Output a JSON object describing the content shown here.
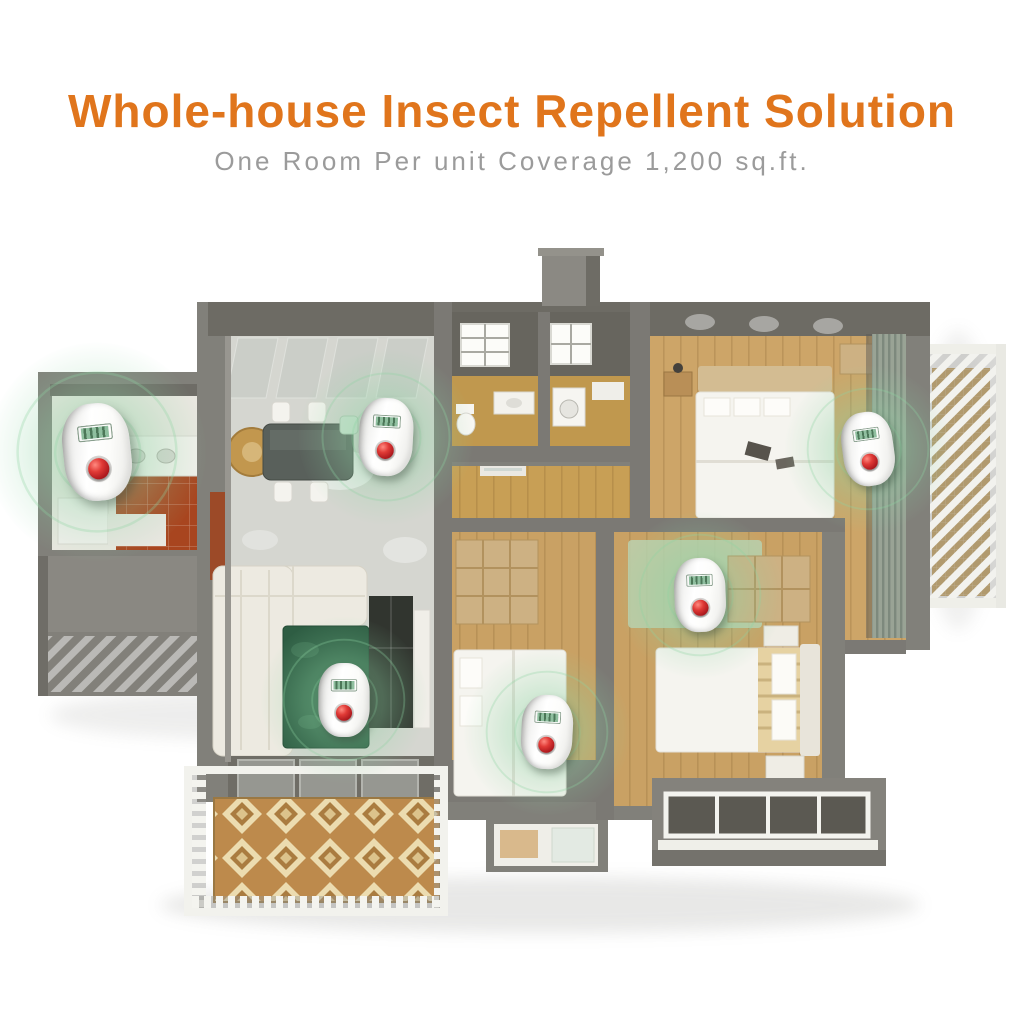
{
  "header": {
    "title": "Whole-house Insect Repellent Solution",
    "subtitle": "One Room Per unit Coverage 1,200 sq.ft."
  },
  "colors": {
    "accent_orange": "#e0751c",
    "subtitle_gray": "#9b9b9b",
    "wall_gray": "#81807a",
    "marble_floor": "#d5d6d0",
    "wood_floor": "#c9a164",
    "terracotta_floor": "#a8451f",
    "rug_green": "#2e5d43",
    "balcony_tile_tan": "#bd8a4c",
    "device_body": "#fdfdfb",
    "device_screen": "#8fbf9f",
    "device_button": "#c41f26",
    "device_glow": "#8dd3a3"
  },
  "floorplan": {
    "device_count": 6,
    "rooms": [
      "kitchen",
      "living-room",
      "dining-area",
      "bathroom",
      "hallway",
      "master-bedroom",
      "bedroom-middle",
      "bedroom-right",
      "balconies"
    ],
    "devices": [
      {
        "room": "kitchen",
        "x": 97,
        "y": 452,
        "rot": -6,
        "scale": 1.25
      },
      {
        "room": "dining-area",
        "x": 386,
        "y": 437,
        "rot": 3,
        "scale": 1.0
      },
      {
        "room": "master-bedroom",
        "x": 868,
        "y": 449,
        "rot": -8,
        "scale": 0.95
      },
      {
        "room": "bedroom-right",
        "x": 700,
        "y": 595,
        "rot": -2,
        "scale": 0.95
      },
      {
        "room": "bedroom-middle",
        "x": 547,
        "y": 732,
        "rot": 3,
        "scale": 0.95
      },
      {
        "room": "living-room",
        "x": 344,
        "y": 700,
        "rot": 0,
        "scale": 0.95
      }
    ]
  }
}
